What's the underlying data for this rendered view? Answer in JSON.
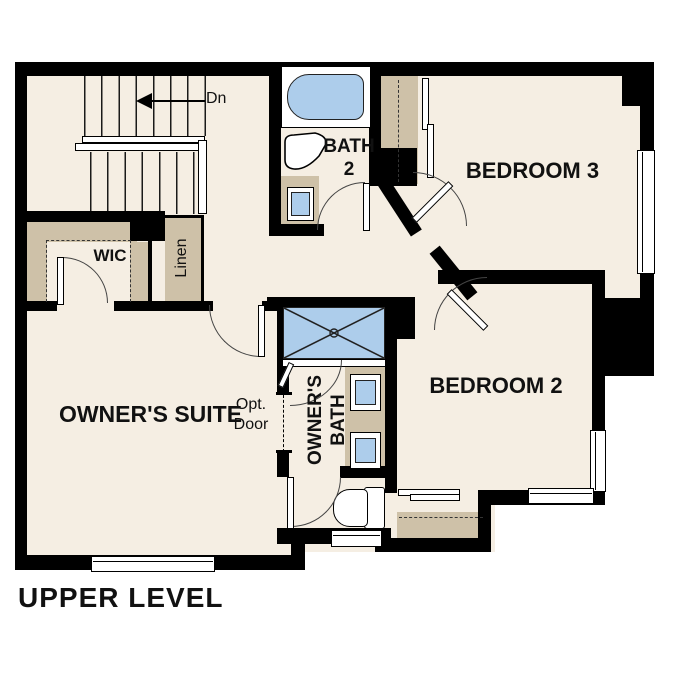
{
  "title": "UPPER LEVEL",
  "colors": {
    "floor": "#f5eee3",
    "cabinet": "#cec1a8",
    "fixture": "#adcdeb",
    "wall": "#000000"
  },
  "rooms": {
    "owners_suite": "OWNER'S SUITE",
    "bedroom2": "BEDROOM 2",
    "bedroom3": "BEDROOM 3",
    "bath2": "BATH 2",
    "owners_bath": "OWNER'S BATH",
    "wic": "WIC",
    "linen": "Linen"
  },
  "annotations": {
    "stairs_down": "Dn",
    "opt_door": "Opt. Door"
  },
  "fixtures": [
    "bathtub",
    "pedestal-sink",
    "vanity-sink",
    "shower",
    "toilet",
    "stairs",
    "window",
    "sliding-closet-door"
  ]
}
